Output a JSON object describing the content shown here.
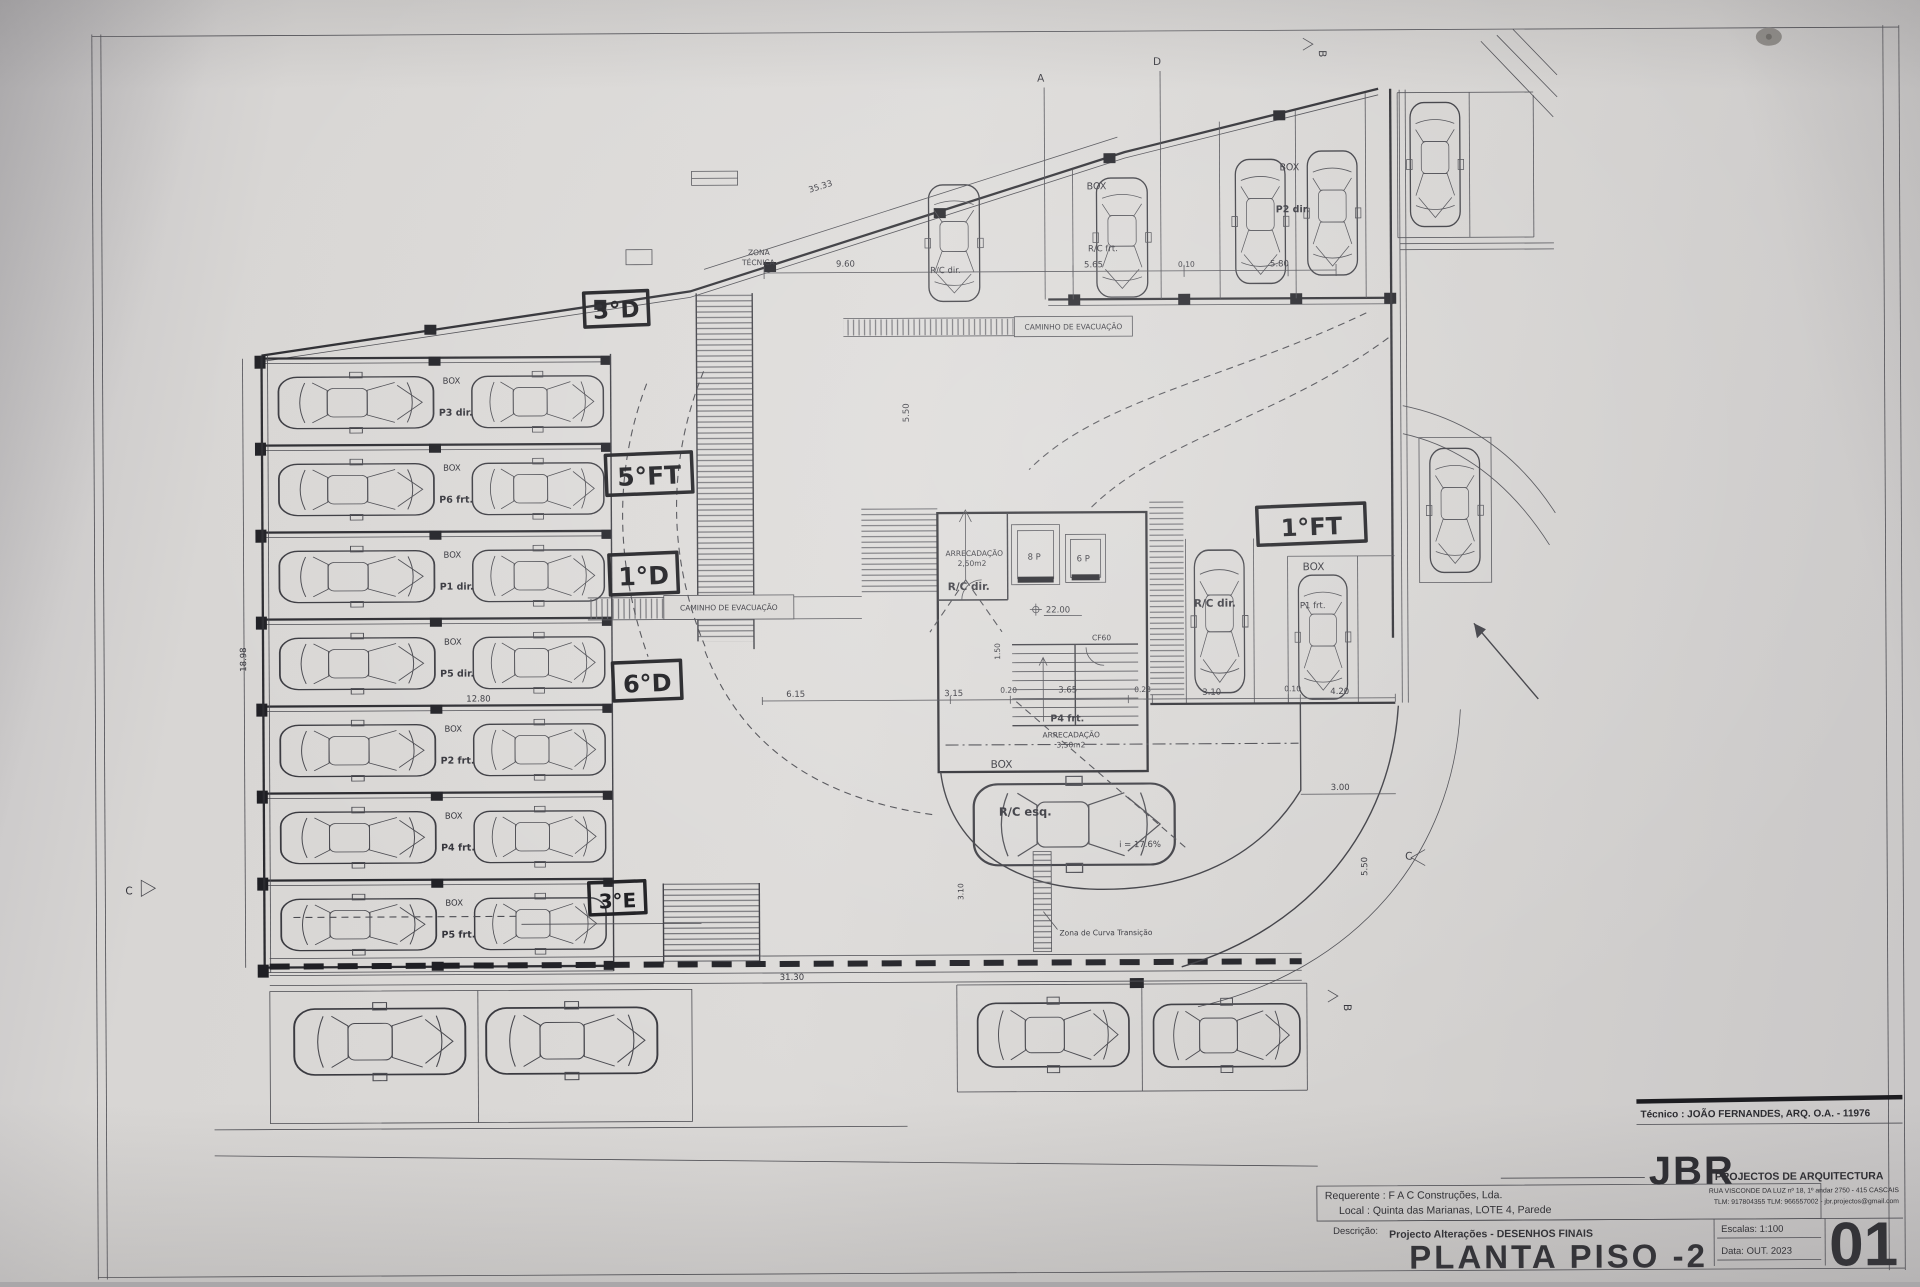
{
  "titleblock": {
    "tecnico_line": "Técnico : JOÃO FERNANDES, ARQ.   O.A. - 11976",
    "requerente_line": "Requerente : F A C  Construções, Lda.",
    "local_line": "Local : Quinta das Marianas, LOTE 4, Parede",
    "descricao_label": "Descrição:",
    "descricao_value": "Projecto Alterações - DESENHOS FINAIS",
    "title": "PLANTA PISO -2",
    "firm_initials": "JBR",
    "firm_name": "PROJECTOS DE ARQUITECTURA",
    "firm_address": "RUA VISCONDE DA LUZ nº 18, 1º andar  2750 - 415  CASCAIS",
    "firm_contacts": "TLM: 917804355  TLM: 966557002 - jbr.projectos@gmail.com",
    "escalas_line": "Escalas:  1:100",
    "data_line": "Data:  OUT.  2023",
    "sheet_number": "01"
  },
  "handwritten": {
    "n1": "3°D",
    "n2": "5°FT",
    "n3": "1°D",
    "n4": "6°D",
    "n5": "3°E",
    "n6": "1°FT"
  },
  "labels": {
    "box": "BOX",
    "zona1": "ZONA",
    "zona2": "TÉCNICA",
    "caminho": "CAMINHO DE EVACUAÇÃO",
    "rc_frt": "R/C frt.",
    "p2_dir": "P2 dir.",
    "rc_dir": "R/C dir.",
    "rc_esq": "R/C esq.",
    "p1_frt": "P1 frt.",
    "p4_frt": "P4 frt.",
    "arrecadacao": "ARRECADAÇÃO",
    "area_small": "2,50m2",
    "area_large": "3,50m2",
    "lift8": "8 P",
    "lift6": "6 P",
    "level": "22.00",
    "door": "CF60",
    "slope": "i = 17.6%",
    "curve": "Zona de Curva Transição"
  },
  "parking_rows": [
    {
      "box": "BOX",
      "label": "P3 dir."
    },
    {
      "box": "BOX",
      "label": "P6 frt."
    },
    {
      "box": "BOX",
      "label": "P1 dir."
    },
    {
      "box": "BOX",
      "label": "P5 dir."
    },
    {
      "box": "BOX",
      "label": "P2 frt."
    },
    {
      "box": "BOX",
      "label": "P4 frt."
    },
    {
      "box": "BOX",
      "label": "P5 frt."
    }
  ],
  "dims": {
    "top_slant": "35.33",
    "top_mid": "9.60",
    "top_565": "5.65",
    "top_010": "0.10",
    "top_580": "5.80",
    "ramp_550": "5.50",
    "mid_615": "6.15",
    "mid_315": "3.15",
    "mid_020": "0.20",
    "mid_365": "3.65",
    "mid_023": "0.23",
    "mid_310": "3.10",
    "mid_010": "0.10",
    "mid_420": "4.20",
    "right_300": "3.00",
    "right_550": "5.50",
    "bottom_3130": "31.30",
    "rows_1280": "12.80",
    "left_1898": "18.98",
    "core_150": "1.50",
    "curve_310": "3.10"
  },
  "markers": {
    "a": "A",
    "b": "B",
    "c": "C",
    "d": "D"
  }
}
